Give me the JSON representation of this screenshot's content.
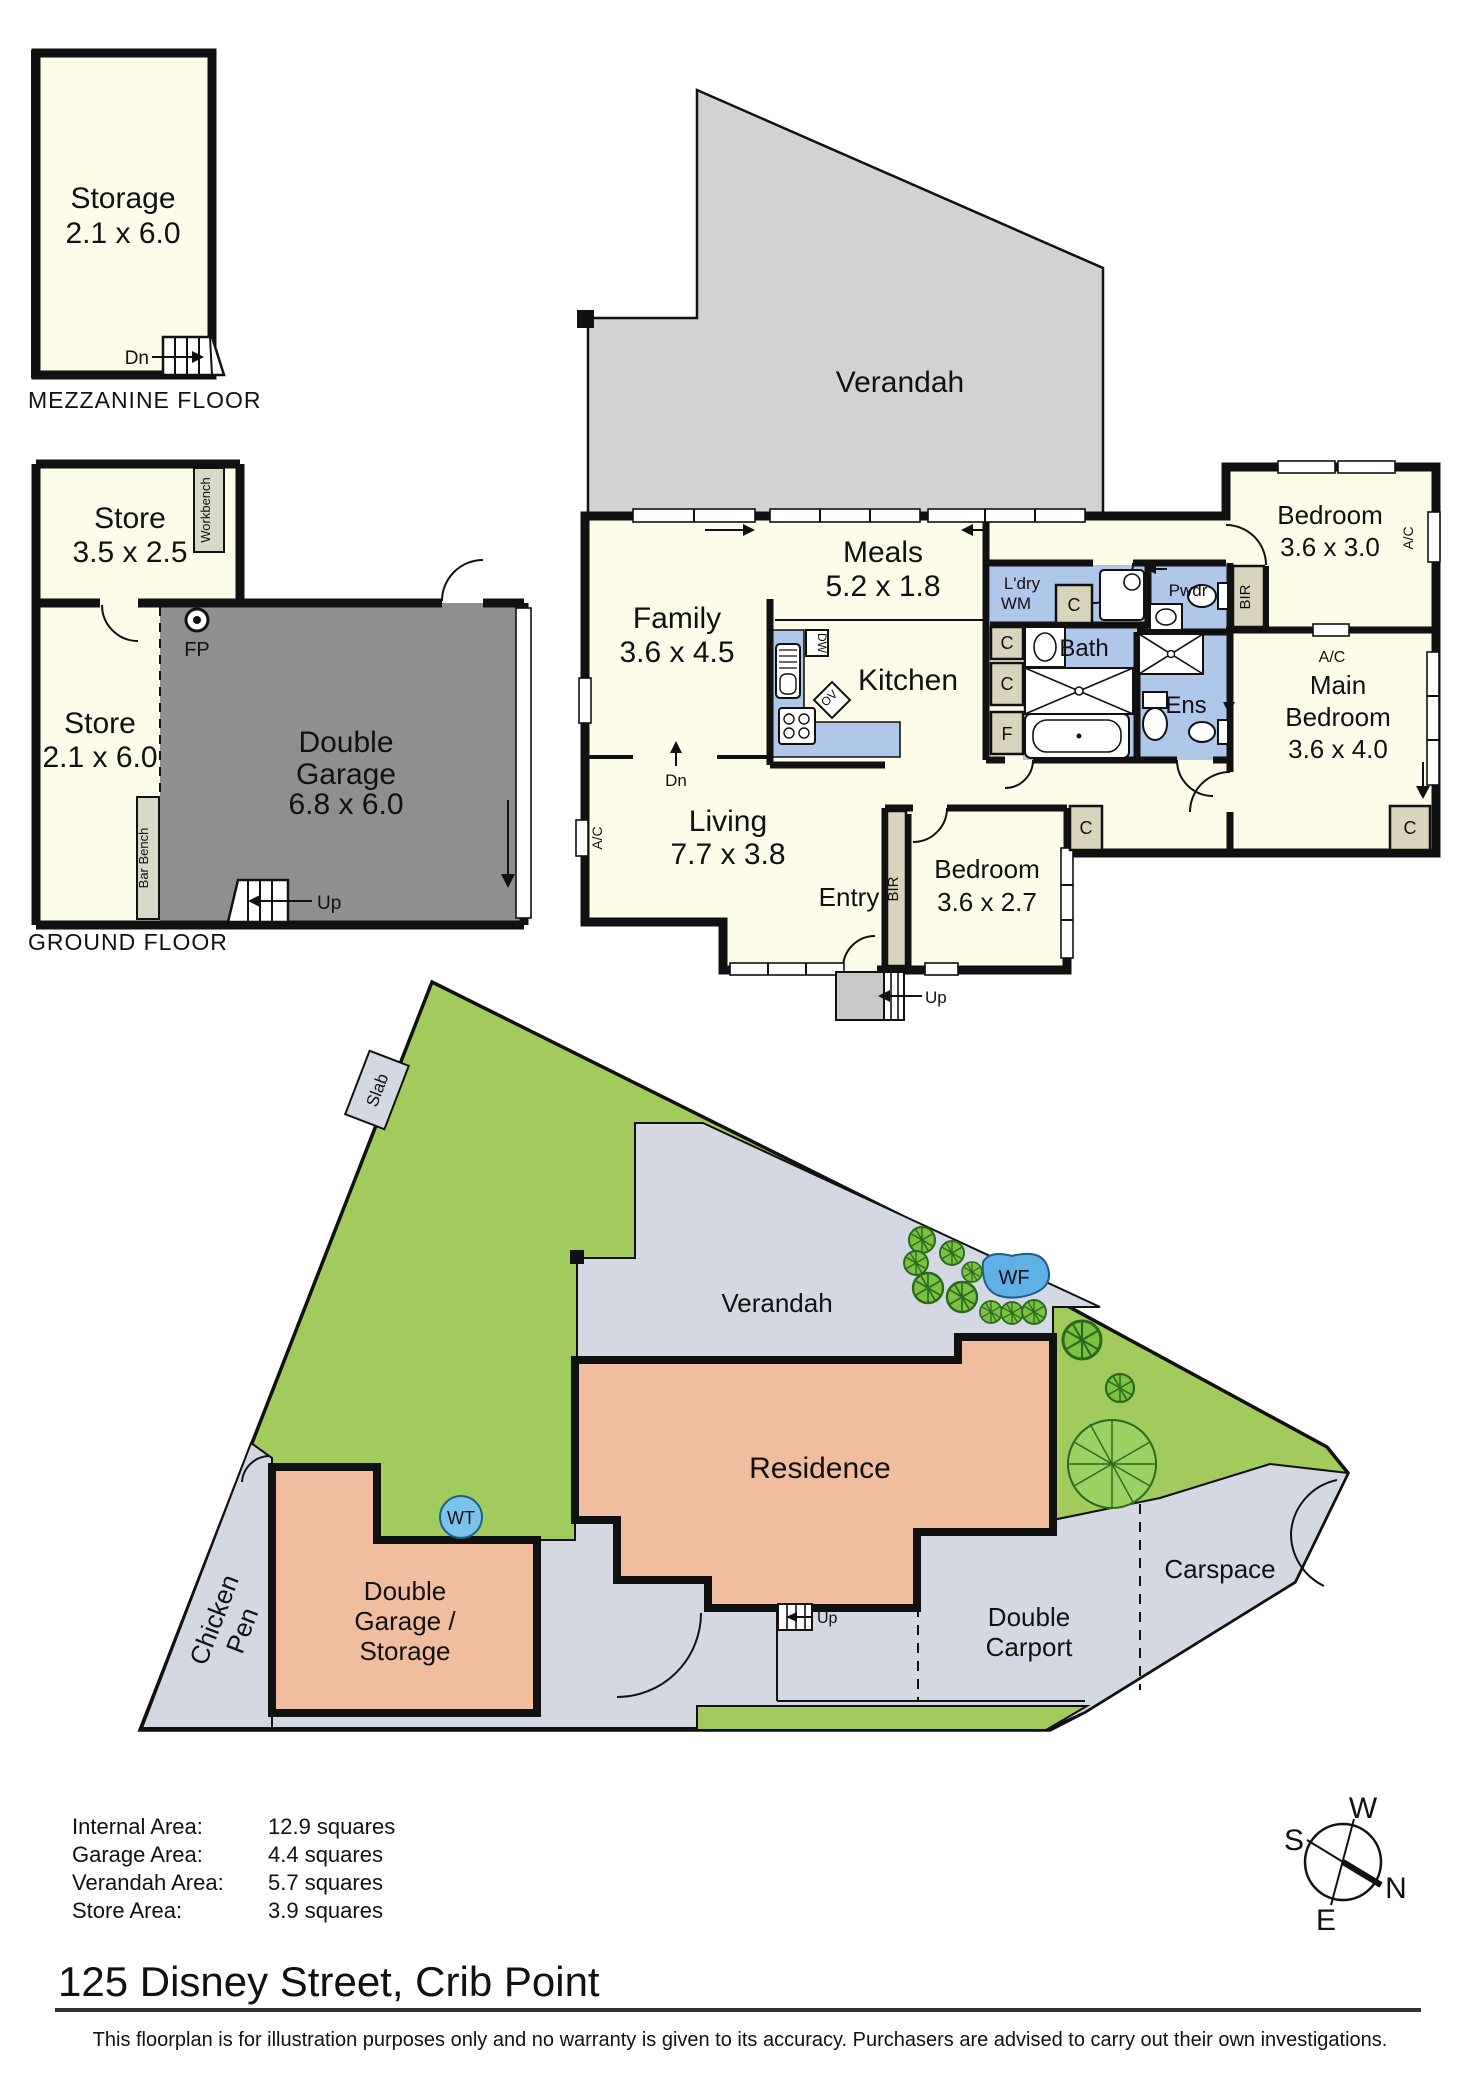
{
  "mezzanine": {
    "room": "Storage",
    "dims": "2.1 x 6.0",
    "stair": "Dn",
    "floor": "MEZZANINE FLOOR"
  },
  "ground": {
    "store1": "Store",
    "store1_dims": "3.5 x 2.5",
    "workbench": "Workbench",
    "store2": "Store",
    "store2_dims": "2.1 x 6.0",
    "garage_l1": "Double",
    "garage_l2": "Garage",
    "garage_dims": "6.8 x 6.0",
    "fp": "FP",
    "bar_bench": "Bar Bench",
    "stair": "Up",
    "floor": "GROUND FLOOR"
  },
  "main": {
    "verandah": "Verandah",
    "meals": "Meals",
    "meals_dims": "5.2 x 1.8",
    "family": "Family",
    "family_dims": "3.6 x 4.5",
    "kitchen": "Kitchen",
    "dn": "Dn",
    "living": "Living",
    "living_dims": "7.7 x 3.8",
    "entry": "Entry",
    "up": "Up",
    "ldry": "L'dry",
    "wm": "WM",
    "pwdr": "Pwdr",
    "bath": "Bath",
    "ens": "Ens",
    "bir": "BIR",
    "bedroom1": "Bedroom",
    "bedroom1_dims": "3.6 x 3.0",
    "main_bed_l1": "Main",
    "main_bed_l2": "Bedroom",
    "main_bed_dims": "3.6 x 4.0",
    "bedroom2": "Bedroom",
    "bedroom2_dims": "3.6 x 2.7",
    "ac": "A/C",
    "c": "C",
    "f": "F",
    "dw": "DW",
    "ov": "OV"
  },
  "site": {
    "slab": "Slab",
    "verandah": "Verandah",
    "residence": "Residence",
    "wf": "WF",
    "wt": "WT",
    "chicken_l1": "Chicken",
    "chicken_l2": "Pen",
    "garage_l1": "Double",
    "garage_l2": "Garage /",
    "garage_l3": "Storage",
    "carport_l1": "Double",
    "carport_l2": "Carport",
    "carspace": "Carspace",
    "up": "Up"
  },
  "summary": {
    "rows": [
      {
        "label": "Internal Area:",
        "value": "12.9 squares"
      },
      {
        "label": "Garage  Area:",
        "value": "4.4 squares"
      },
      {
        "label": "Verandah  Area:",
        "value": "5.7 squares"
      },
      {
        "label": "Store  Area:",
        "value": "3.9 squares"
      }
    ]
  },
  "compass": {
    "n": "N",
    "s": "S",
    "e": "E",
    "w": "W"
  },
  "address": "125 Disney Street, Crib Point",
  "disclaimer": "This floorplan is for illustration purposes only and no warranty is given to its accuracy. Purchasers are advised to carry out their own investigations.",
  "colors": {
    "room_fill": "#FDFCE8",
    "verandah_gray": "#D2D2D2",
    "garage_gray": "#8F8F8F",
    "wet_blue": "#AFC8EA",
    "site_green": "#A2CB5E",
    "site_gray": "#D3D8E2",
    "residence_salmon": "#F0BE9E",
    "tree_green": "#7CC142",
    "water_blue": "#5FB0E5",
    "wall": "#111111"
  }
}
